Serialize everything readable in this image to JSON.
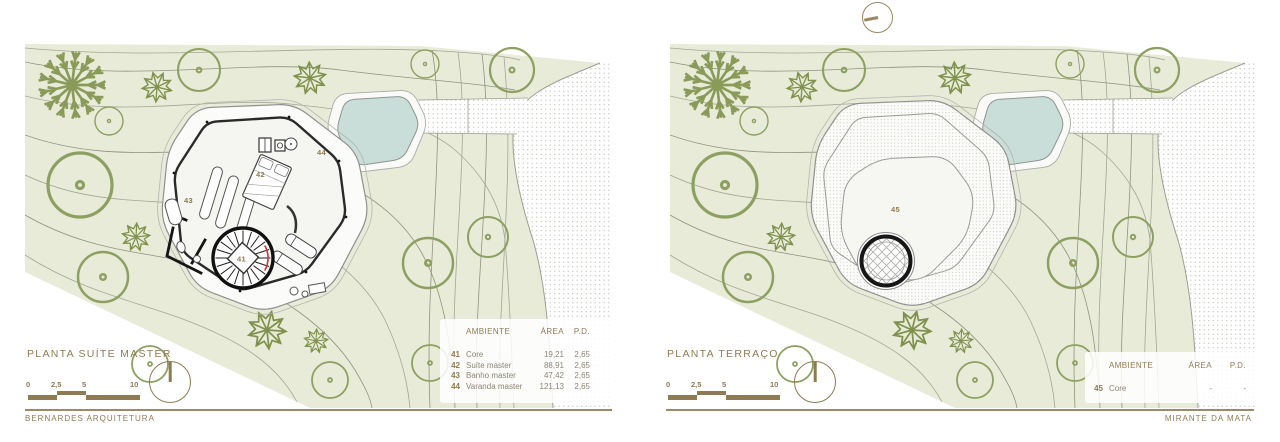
{
  "icons": {
    "north_arrow": "north-arrow-icon",
    "orientation_marker": "orientation-marker-icon"
  },
  "colors": {
    "accent_brown": "#8f7b52",
    "site_green": "#e9ebd9",
    "pool_blue": "#c9ded8",
    "wall_black": "#1d1d1d",
    "contour_gray": "#a2a795",
    "tree_olive": "#8da061",
    "stair_red": "#cf3333"
  },
  "panels": {
    "left": {
      "title": "PLANTA SUÍTE MASTER",
      "scale_bar": {
        "labels": [
          "0",
          "2,5",
          "5",
          "10"
        ]
      },
      "plan_labels": [
        "41",
        "42",
        "43",
        "44"
      ],
      "table": {
        "headers": [
          "AMBIENTE",
          "ÁREA",
          "P.D."
        ],
        "rows": [
          {
            "num": "41",
            "name": "Core",
            "area": "19,21",
            "pd": "2,65"
          },
          {
            "num": "42",
            "name": "Suíte master",
            "area": "88,91",
            "pd": "2,65"
          },
          {
            "num": "43",
            "name": "Banho master",
            "area": "47,42",
            "pd": "2,65"
          },
          {
            "num": "44",
            "name": "Varanda master",
            "area": "121,13",
            "pd": "2,65"
          }
        ]
      }
    },
    "right": {
      "title": "PLANTA TERRAÇO",
      "scale_bar": {
        "labels": [
          "0",
          "2,5",
          "5",
          "10"
        ]
      },
      "plan_labels": [
        "45"
      ],
      "table": {
        "headers": [
          "AMBIENTE",
          "ÁREA",
          "P.D."
        ],
        "rows": [
          {
            "num": "45",
            "name": "Core",
            "area": "-",
            "pd": "-"
          }
        ]
      }
    }
  },
  "footer": {
    "left": "BERNARDES ARQUITETURA",
    "right": "MIRANTE DA MATA"
  }
}
